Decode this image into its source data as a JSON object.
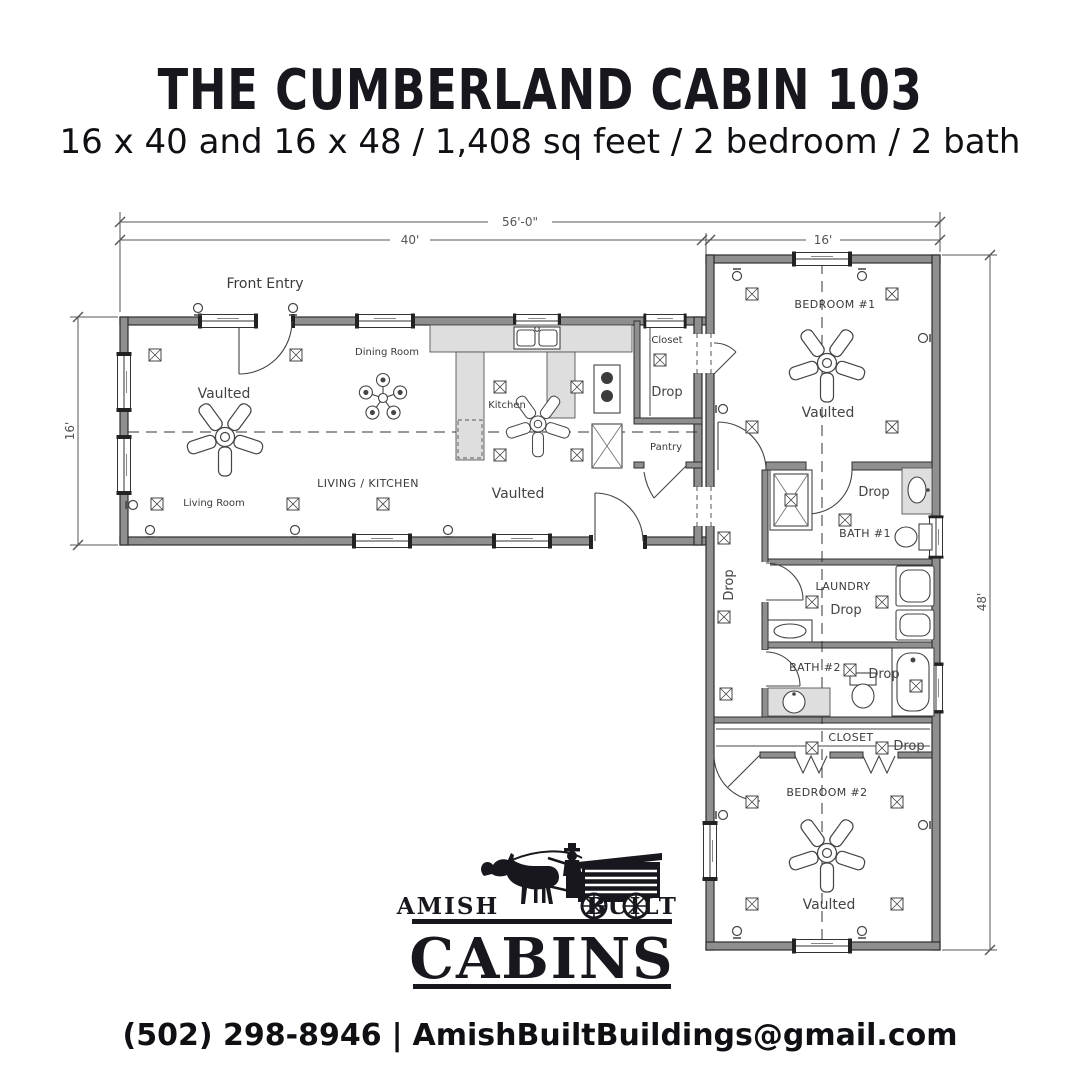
{
  "page": {
    "title": "THE CUMBERLAND CABIN 103",
    "subtitle": "16 x 40 and 16 x 48 / 1,408 sq feet / 2 bedroom / 2 bath"
  },
  "plan": {
    "dimensions": {
      "overall": "56'-0\"",
      "left_len": "40'",
      "right_width": "16'",
      "depth": "16'",
      "right_len": "48'"
    },
    "labels": {
      "front_entry": "Front Entry",
      "dining_room": "Dining Room",
      "kitchen": "Kitchen",
      "living_kitchen": "LIVING / KITCHEN",
      "living_room": "Living Room",
      "vaulted": "Vaulted",
      "closet": "Closet",
      "drop": "Drop",
      "pantry": "Pantry",
      "bedroom1": "BEDROOM #1",
      "bath1": "BATH #1",
      "laundry": "LAUNDRY",
      "bath2": "BATH #2",
      "closet2": "CLOSET",
      "bedroom2": "BEDROOM #2"
    }
  },
  "logo": {
    "amish": "AMISH",
    "built": "BUILT",
    "cabins": "CABINS"
  },
  "footer": {
    "phone": "(502) 298-8946",
    "sep": "|",
    "email": "AmishBuiltBuildings@gmail.com"
  }
}
